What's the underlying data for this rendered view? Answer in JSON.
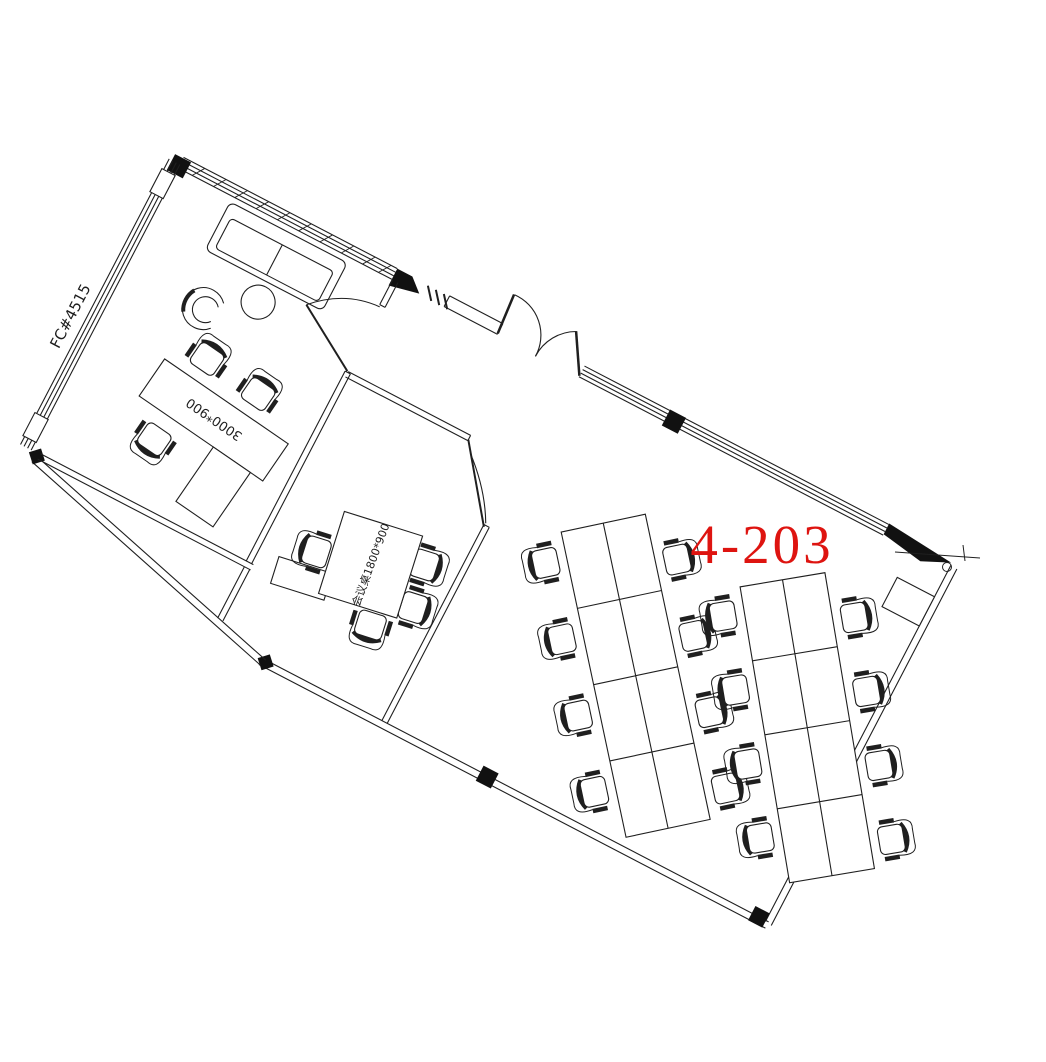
{
  "drawing": {
    "room_number": "4-203",
    "wall_tag": "FC#4515",
    "private_office_desk_label": "3000*900",
    "meeting_table_label": "会议桌1800*900",
    "colors": {
      "line": "#1f1f1f",
      "room_number_red": "#de1410",
      "background": "#ffffff"
    }
  }
}
